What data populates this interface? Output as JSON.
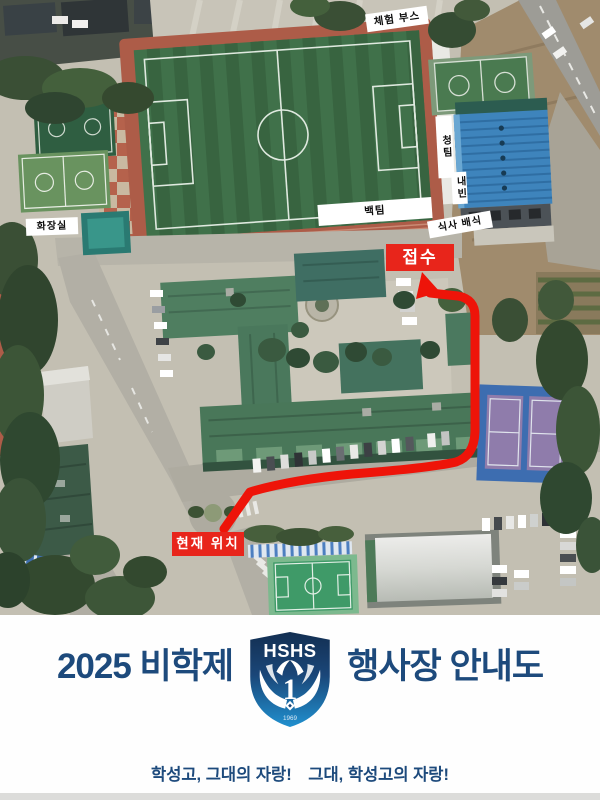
{
  "map": {
    "labels": {
      "experience_booth": "체험 부스",
      "blue_team": "청팀",
      "vip_guests": "내빈",
      "white_team": "백팀",
      "meal_service": "식사 배식",
      "restroom": "화장실",
      "reception": "접수",
      "current_location": "현재 위치"
    },
    "colors": {
      "route": "#ee1409",
      "marker_background": "#e8251b"
    }
  },
  "footer": {
    "title_left": "2025 비학제",
    "title_right": "행사장 안내도",
    "title_color": "#1d4a7c",
    "slogan_first": "학성고, 그대의 자랑!",
    "slogan_second": "그대, 학성고의 자랑!",
    "logo": {
      "acronym": "HSHS",
      "number": "1",
      "year": "1969"
    }
  }
}
